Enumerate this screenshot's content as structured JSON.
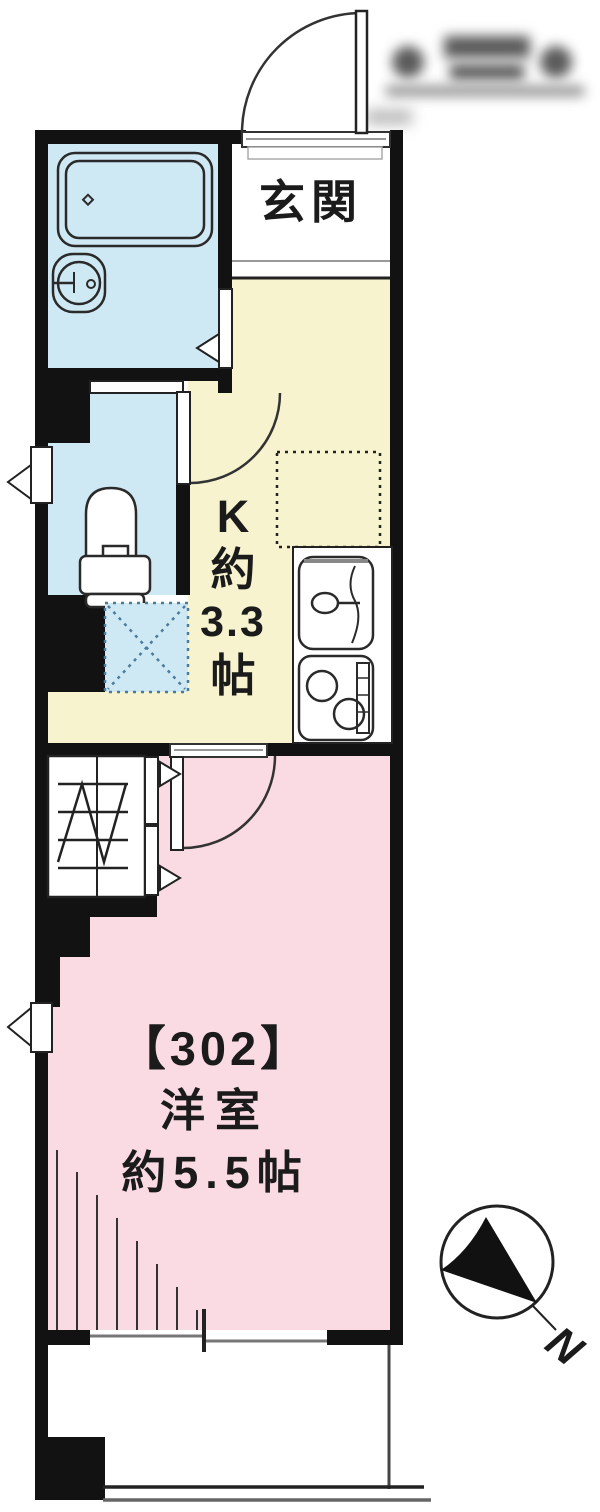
{
  "document": {
    "type": "apartment-floorplan",
    "unit_number": "302"
  },
  "labels": {
    "genkan": "玄関",
    "kitchen_lines": [
      "K",
      "約",
      "3.3",
      "帖"
    ],
    "kitchen_full": "K約3.3帖",
    "room_lines": [
      "【302】",
      "洋室",
      "約5.5帖"
    ],
    "room_full": "【302】洋室 約5.5帖",
    "compass_north": "N"
  },
  "areas": {
    "kitchen_jo": "3.3",
    "western_room_jo": "5.5"
  },
  "colors": {
    "bathroom": "#cfe9f4",
    "toilet": "#cfe9f4",
    "washing_machine": "#cfe9f4",
    "kitchen": "#f8f3cf",
    "western_room": "#fadbe3",
    "hall": "#ffffff",
    "wall": "#121212"
  },
  "fixtures": [
    "bathtub",
    "washbasin",
    "toilet",
    "washing-machine-space",
    "refrigerator-space",
    "kitchen-sink",
    "gas-stove",
    "closet",
    "entrance-door",
    "room-door",
    "toilet-door",
    "bathroom-door",
    "sliding-window",
    "side-windows",
    "balcony-rail",
    "compass"
  ]
}
